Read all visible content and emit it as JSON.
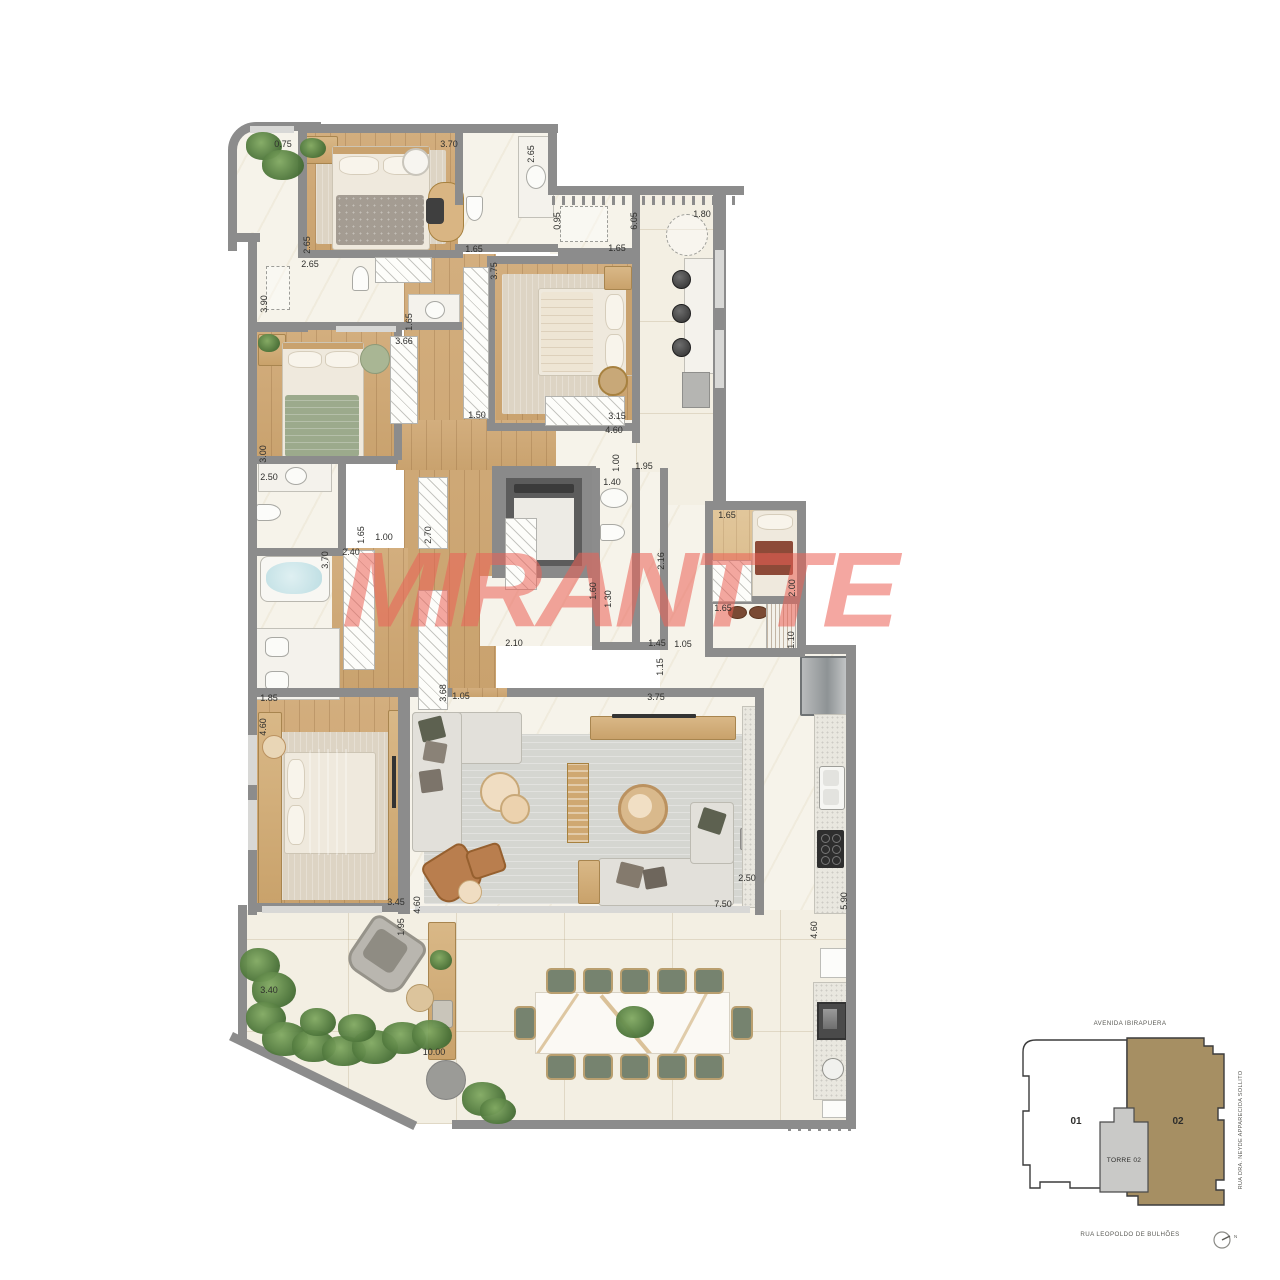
{
  "watermark": "MIRANTTE",
  "colors": {
    "wall": "#8c8c8c",
    "wood_floor": "#cda670",
    "marble_floor": "#f6f3ea",
    "terrace_floor": "#f3efe3",
    "watermark_red": "#ec6156",
    "keyplan_unit_fill": "#a68f63",
    "chair_green": "#76836f"
  },
  "keyplan": {
    "street_top": "AVENIDA IBIRAPUERA",
    "street_right": "RUA DRA. NEYDE APPARECIDA SOLLITO",
    "street_bottom": "RUA LEOPOLDO DE BULHÕES",
    "unit_left": "01",
    "unit_right": "02",
    "tower": "TORRE 02",
    "compass": "N"
  },
  "dims": [
    {
      "t": "0.75",
      "x": 283,
      "y": 144,
      "v": 0
    },
    {
      "t": "3.70",
      "x": 449,
      "y": 144,
      "v": 0
    },
    {
      "t": "1.80",
      "x": 702,
      "y": 214,
      "v": 0
    },
    {
      "t": "2.65",
      "x": 310,
      "y": 264,
      "v": 0
    },
    {
      "t": "1.65",
      "x": 474,
      "y": 249,
      "v": 0
    },
    {
      "t": "1.65",
      "x": 617,
      "y": 248,
      "v": 0
    },
    {
      "t": "3.66",
      "x": 404,
      "y": 341,
      "v": 0
    },
    {
      "t": "1.50",
      "x": 477,
      "y": 415,
      "v": 0
    },
    {
      "t": "3.15",
      "x": 617,
      "y": 416,
      "v": 0
    },
    {
      "t": "4.60",
      "x": 614,
      "y": 430,
      "v": 0
    },
    {
      "t": "1.95",
      "x": 644,
      "y": 466,
      "v": 0
    },
    {
      "t": "1.40",
      "x": 612,
      "y": 482,
      "v": 0
    },
    {
      "t": "2.50",
      "x": 269,
      "y": 477,
      "v": 0
    },
    {
      "t": "1.00",
      "x": 384,
      "y": 537,
      "v": 0
    },
    {
      "t": "2.40",
      "x": 351,
      "y": 552,
      "v": 0
    },
    {
      "t": "1.65",
      "x": 727,
      "y": 515,
      "v": 0
    },
    {
      "t": "1.65",
      "x": 723,
      "y": 608,
      "v": 0
    },
    {
      "t": "2.10",
      "x": 514,
      "y": 643,
      "v": 0
    },
    {
      "t": "1.45",
      "x": 657,
      "y": 643,
      "v": 0
    },
    {
      "t": "1.05",
      "x": 683,
      "y": 644,
      "v": 0
    },
    {
      "t": "1.85",
      "x": 269,
      "y": 698,
      "v": 0
    },
    {
      "t": "1.05",
      "x": 461,
      "y": 696,
      "v": 0
    },
    {
      "t": "3.75",
      "x": 656,
      "y": 697,
      "v": 0
    },
    {
      "t": "3.45",
      "x": 396,
      "y": 902,
      "v": 0
    },
    {
      "t": "2.50",
      "x": 747,
      "y": 878,
      "v": 0
    },
    {
      "t": "7.50",
      "x": 723,
      "y": 904,
      "v": 0
    },
    {
      "t": "3.40",
      "x": 269,
      "y": 990,
      "v": 0
    },
    {
      "t": "10.00",
      "x": 434,
      "y": 1052,
      "v": 0
    },
    {
      "t": "2.65",
      "x": 531,
      "y": 154,
      "v": 1
    },
    {
      "t": "0.95",
      "x": 557,
      "y": 221,
      "v": 1
    },
    {
      "t": "6.05",
      "x": 634,
      "y": 221,
      "v": 1
    },
    {
      "t": "2.65",
      "x": 307,
      "y": 245,
      "v": 1
    },
    {
      "t": "3.90",
      "x": 264,
      "y": 304,
      "v": 1
    },
    {
      "t": "3.75",
      "x": 494,
      "y": 271,
      "v": 1
    },
    {
      "t": "1.65",
      "x": 409,
      "y": 322,
      "v": 1
    },
    {
      "t": "3.00",
      "x": 263,
      "y": 454,
      "v": 1
    },
    {
      "t": "1.65",
      "x": 361,
      "y": 535,
      "v": 1
    },
    {
      "t": "2.70",
      "x": 428,
      "y": 535,
      "v": 1
    },
    {
      "t": "3.70",
      "x": 325,
      "y": 560,
      "v": 1
    },
    {
      "t": "1.00",
      "x": 616,
      "y": 463,
      "v": 1
    },
    {
      "t": "2.16",
      "x": 661,
      "y": 561,
      "v": 1
    },
    {
      "t": "1.60",
      "x": 593,
      "y": 591,
      "v": 1
    },
    {
      "t": "1.30",
      "x": 608,
      "y": 599,
      "v": 1
    },
    {
      "t": "2.00",
      "x": 792,
      "y": 588,
      "v": 1
    },
    {
      "t": "1.10",
      "x": 791,
      "y": 640,
      "v": 1
    },
    {
      "t": "1.15",
      "x": 660,
      "y": 667,
      "v": 1
    },
    {
      "t": "3.68",
      "x": 443,
      "y": 693,
      "v": 1
    },
    {
      "t": "4.60",
      "x": 263,
      "y": 727,
      "v": 1
    },
    {
      "t": "4.60",
      "x": 417,
      "y": 905,
      "v": 1
    },
    {
      "t": "1.95",
      "x": 401,
      "y": 927,
      "v": 1
    },
    {
      "t": "5.90",
      "x": 844,
      "y": 901,
      "v": 1
    },
    {
      "t": "4.60",
      "x": 814,
      "y": 930,
      "v": 1
    }
  ]
}
